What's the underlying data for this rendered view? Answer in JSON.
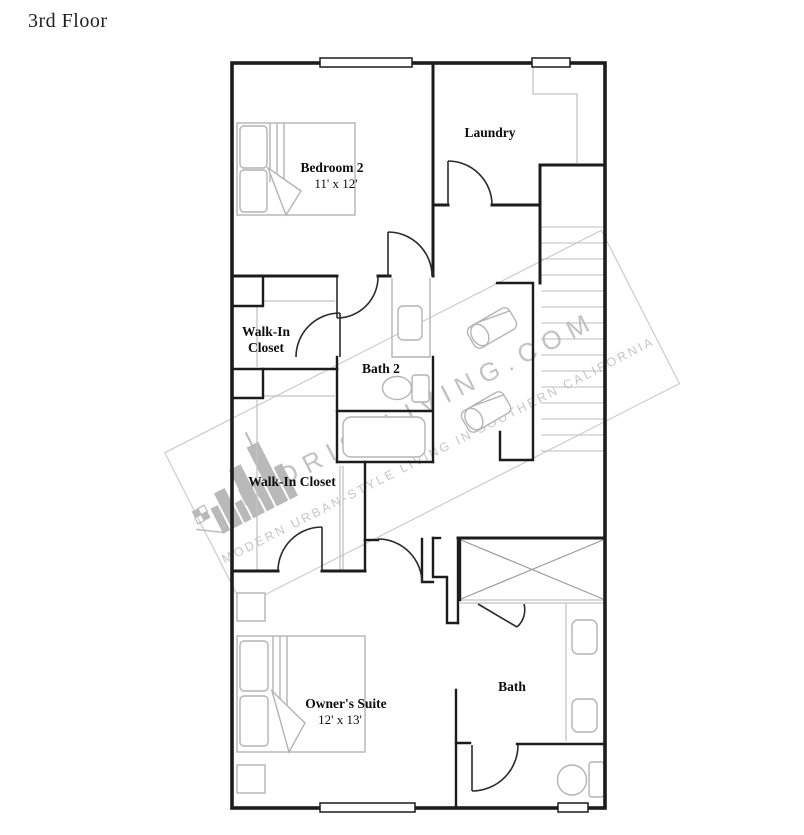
{
  "page": {
    "title": "3rd Floor"
  },
  "floorplan": {
    "rooms": {
      "bedroom2": {
        "name": "Bedroom 2",
        "dims": "11' x 12'"
      },
      "laundry": {
        "name": "Laundry"
      },
      "walk_in_closet_upper": {
        "line1": "Walk-In",
        "line2": "Closet"
      },
      "bath2": {
        "name": "Bath 2"
      },
      "walk_in_closet_lower": {
        "name": "Walk-In Closet"
      },
      "owners_suite": {
        "name": "Owner's Suite",
        "dims": "12' x 13'"
      },
      "bath": {
        "name": "Bath"
      }
    },
    "watermark": {
      "logo": "midrise-skyline-logo",
      "main": "MIDRISELIVING.COM",
      "tagline": "MODERN URBAN-STYLE LIVING IN SOUTHERN CALIFORNIA"
    },
    "colors": {
      "wall": "#1c1c1c",
      "furniture": "#b4b4b4",
      "watermark": "#c2c2c2",
      "background": "#ffffff"
    }
  }
}
